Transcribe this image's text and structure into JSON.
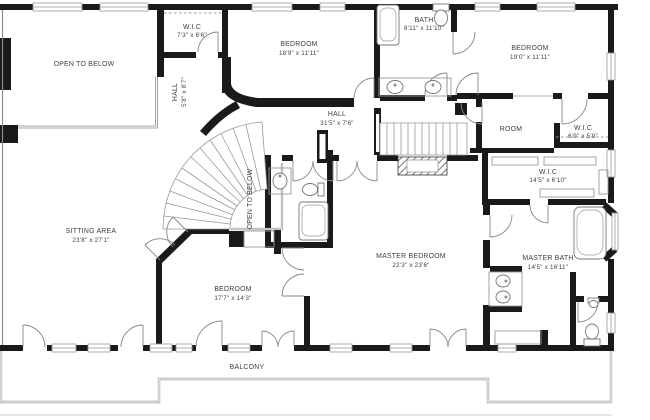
{
  "title": "Second floor plan",
  "colors": {
    "wall": "#1a1a1a",
    "thin_line": "#999999",
    "railing": "#8a8a8a",
    "text": "#3f3f3f",
    "background": "#ffffff"
  },
  "icons": [
    "bathtub-icon",
    "toilet-icon",
    "sink-icon",
    "double-sink-icon",
    "stairs-curved-icon",
    "stairs-straight-icon",
    "door-arc-icon",
    "window-icon",
    "closet-rod-icon",
    "cabinet-icon"
  ],
  "rooms": [
    {
      "id": "wic-top",
      "name": "W.I.C",
      "dims": "7'3\" x 6'6\""
    },
    {
      "id": "open-to-below-top",
      "name": "OPEN TO BELOW",
      "dims": ""
    },
    {
      "id": "bedroom-top-left",
      "name": "BEDROOM",
      "dims": "18'9\" x 11'11\""
    },
    {
      "id": "bath-top",
      "name": "BATH",
      "dims": "8'11\" x 11'10\""
    },
    {
      "id": "bedroom-top-right",
      "name": "BEDROOM",
      "dims": "19'0\" x 11'11\""
    },
    {
      "id": "hall-upper",
      "name": "HALL",
      "dims": "5'8\" x 8'7\""
    },
    {
      "id": "hall-main",
      "name": "HALL",
      "dims": "31'5\" x 7'6\""
    },
    {
      "id": "room",
      "name": "ROOM",
      "dims": ""
    },
    {
      "id": "wic-right-small",
      "name": "W.I.C",
      "dims": "6'9\" x 5'9\""
    },
    {
      "id": "wic-right-large",
      "name": "W.I.C",
      "dims": "14'5\" x 6'10\""
    },
    {
      "id": "open-to-below-stair",
      "name": "OPEN TO BELOW",
      "dims": ""
    },
    {
      "id": "sitting-area",
      "name": "SITTING AREA",
      "dims": "23'8\" x 27'1\""
    },
    {
      "id": "bedroom-lower",
      "name": "BEDROOM",
      "dims": "17'7\" x 14'3\""
    },
    {
      "id": "master-bedroom",
      "name": "MASTER BEDROOM",
      "dims": "22'3\" x 23'6\""
    },
    {
      "id": "master-bath",
      "name": "MASTER BATH",
      "dims": "14'5\" x 16'11\""
    },
    {
      "id": "balcony",
      "name": "BALCONY",
      "dims": ""
    }
  ]
}
